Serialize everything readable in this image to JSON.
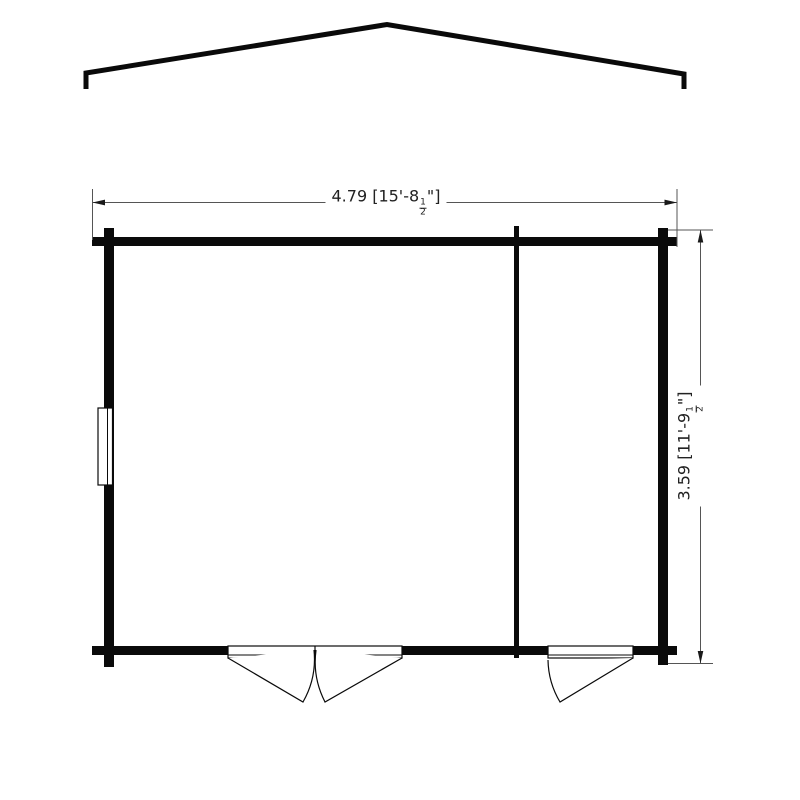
{
  "drawing": {
    "type": "garden-building-floor-plan",
    "dimensions": {
      "width": {
        "metric": "4.79",
        "imperial_prefix": " [15'-8",
        "fraction_numerator": "1",
        "fraction_denominator": "2",
        "imperial_suffix": "\"]"
      },
      "height": {
        "metric": "3.59",
        "imperial_prefix": " [11'-9",
        "fraction_numerator": "1",
        "fraction_denominator": "2",
        "imperial_suffix": "\"]"
      }
    },
    "colors": {
      "wall": "#0a0a0a",
      "dimension_line": "#555555",
      "arrow": "#1a1a1a",
      "text": "#222222",
      "background": "#ffffff"
    }
  }
}
